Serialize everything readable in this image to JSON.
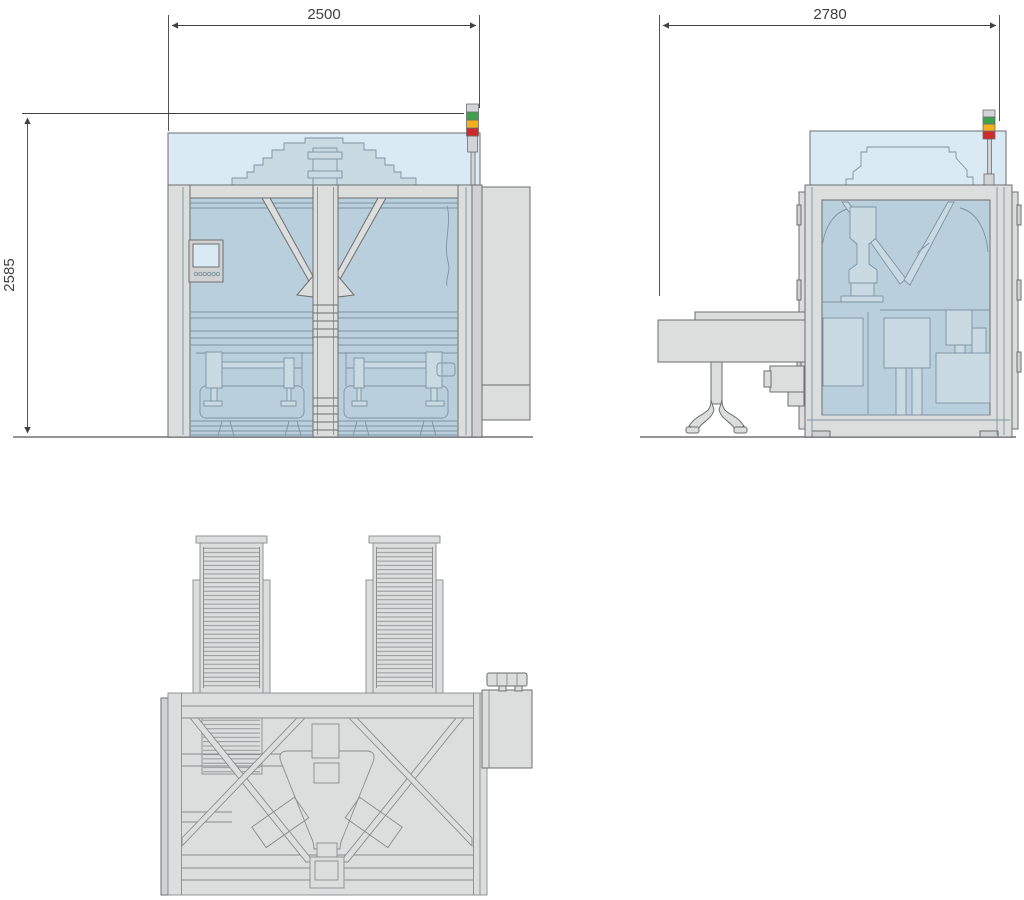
{
  "dimensions": {
    "front_width": "2500",
    "front_height": "2585",
    "side_depth": "2780"
  },
  "colors": {
    "hood_blue": "#d9eaf4",
    "interior_blue": "#b9cfdb",
    "interior_light": "#c9dae3",
    "frame_gray": "#dcdddd",
    "frame_gray_dark": "#cfd1d2",
    "line_dark": "#6d6e70",
    "line_mid": "#7d93a1",
    "line_gray": "#8a8b8d",
    "dim_color": "#414042",
    "ground_color": "#939598",
    "tower_green": "#3fa24a",
    "tower_amber": "#f2b01e",
    "tower_red": "#d0292b",
    "tower_gray": "#d1d3d4"
  }
}
